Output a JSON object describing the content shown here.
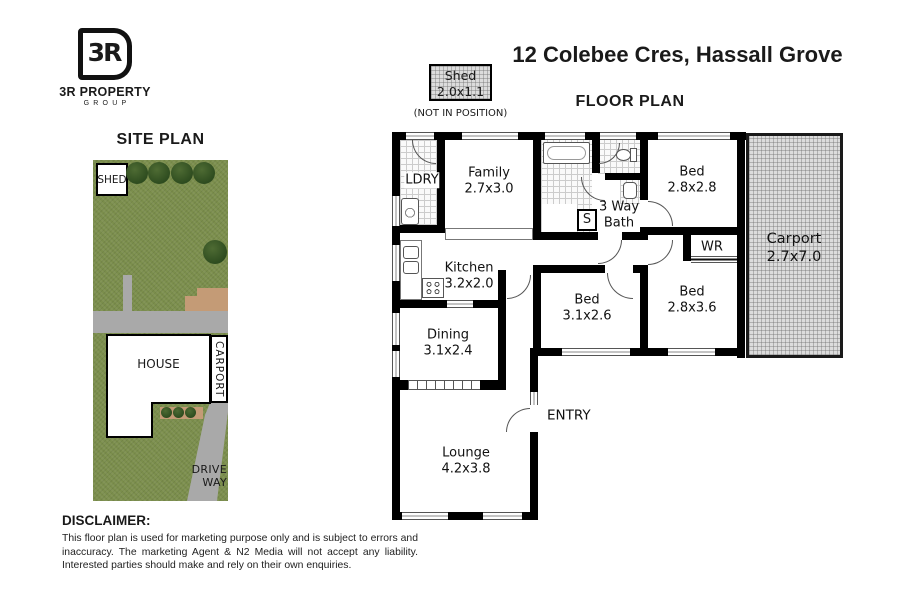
{
  "logo": {
    "monogram": "3R",
    "name": "3R PROPERTY",
    "sub": "GROUP"
  },
  "titles": {
    "address": "12 Colebee Cres, Hassall Grove",
    "floor_plan": "FLOOR PLAN",
    "site_plan": "SITE PLAN"
  },
  "shed_callout": {
    "name": "Shed",
    "dims": "2.0x1.1",
    "note": "(NOT IN POSITION)"
  },
  "floorplan": {
    "ldry": "LDRY",
    "family": {
      "name": "Family",
      "dims": "2.7x3.0"
    },
    "bath": {
      "line1": "3 Way",
      "line2": "Bath"
    },
    "linen": "S",
    "bed_top": {
      "name": "Bed",
      "dims": "2.8x2.8"
    },
    "wardrobe": "WR",
    "carport": {
      "name": "Carport",
      "dims": "2.7x7.0"
    },
    "kitchen": {
      "name": "Kitchen",
      "dims": "3.2x2.0"
    },
    "bed_mid": {
      "name": "Bed",
      "dims": "3.1x2.6"
    },
    "bed_right": {
      "name": "Bed",
      "dims": "2.8x3.6"
    },
    "dining": {
      "name": "Dining",
      "dims": "3.1x2.4"
    },
    "lounge": {
      "name": "Lounge",
      "dims": "4.2x3.8"
    },
    "entry": "ENTRY"
  },
  "site_plan": {
    "shed": "SHED",
    "house": "HOUSE",
    "carport": "CARPORT",
    "driveway": "DRIVE WAY"
  },
  "disclaimer": {
    "heading": "DISCLAIMER:",
    "body": "This floor plan is used for marketing purpose only and is subject to errors and inaccuracy. The marketing Agent & N2 Media will not accept any liability. Interested parties should make and rely on their own enquiries."
  },
  "colors": {
    "grass": "#7b8e4c",
    "paving": "#a9a9a9",
    "patio": "#c49b76",
    "walls": "#000000",
    "carport_fill": "#dcdcdc"
  }
}
